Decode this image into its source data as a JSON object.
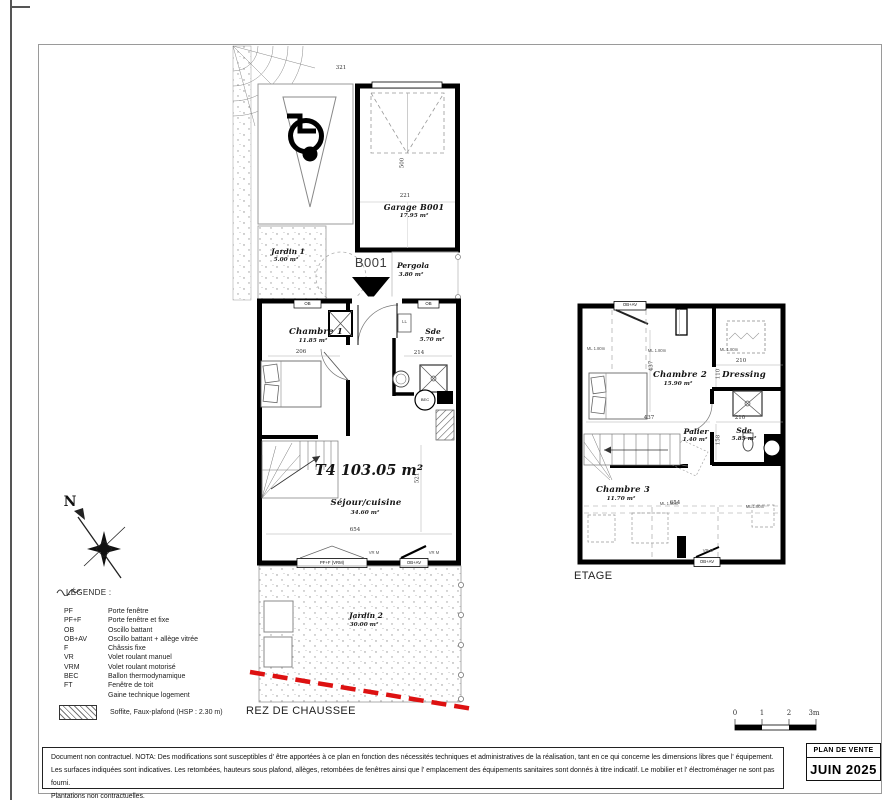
{
  "page": {
    "floor_labels": {
      "ground": "REZ DE CHAUSSEE",
      "upper": "ETAGE"
    },
    "title_box": {
      "title": "PLAN DE VENTE",
      "date": "JUIN 2025"
    },
    "compass_n": "N",
    "scale_ticks": {
      "t0": "0",
      "t1": "1",
      "t2": "2",
      "t3": "3m"
    }
  },
  "ground": {
    "unit_marker": "B001",
    "type_area": "T4 103.05 m²",
    "garage": {
      "name": "Garage B001",
      "area": "17.95 m²",
      "dim_w": "221",
      "dim_h": "500",
      "dim_side": "321"
    },
    "jardin1": {
      "name": "Jardin 1",
      "area": "5.00 m²"
    },
    "pergola": {
      "name": "Pergola",
      "area": "3.80 m²"
    },
    "chambre1": {
      "name": "Chambre 1",
      "area": "11.85 m²",
      "dim": "206"
    },
    "sde": {
      "name": "Sde",
      "area": "5.70 m²",
      "dim": "214"
    },
    "sejour": {
      "name": "Séjour/cuisine",
      "area": "34.60 m²",
      "dim_w": "654",
      "dim_h": "521"
    },
    "jardin2": {
      "name": "Jardin 2",
      "area": "30.00 m²"
    },
    "fixtures": {
      "ll": "LL",
      "bec": "BEC"
    },
    "windows": {
      "ob": "OB",
      "pff": "PF+F (VRM)",
      "obav": "OB+AV",
      "vrm": "VR M"
    }
  },
  "upper": {
    "chambre2": {
      "name": "Chambre 2",
      "area": "15.90 m²",
      "dim_v": "437",
      "dim_h": "437"
    },
    "dressing": {
      "name": "Dressing",
      "dim_w": "210",
      "dim_v": "110"
    },
    "palier": {
      "name": "Palier",
      "area": "1.40 m²"
    },
    "sde": {
      "name": "Sde",
      "area": "5.85 m²",
      "dim_w": "210",
      "dim_v": "158"
    },
    "chambre3": {
      "name": "Chambre 3",
      "area": "11.70 m²",
      "dim_w": "654"
    },
    "height_note": "ML 1.80m",
    "windows": {
      "obav": "OB+AV",
      "vrm": "VR M"
    }
  },
  "legend": {
    "title": "LÉGENDE :",
    "items": [
      {
        "abbr": "PF",
        "label": "Porte fenêtre"
      },
      {
        "abbr": "PF+F",
        "label": "Porte fenêtre et fixe"
      },
      {
        "abbr": "OB",
        "label": "Oscillo battant"
      },
      {
        "abbr": "OB+AV",
        "label": "Oscillo battant + allège vitrée"
      },
      {
        "abbr": "F",
        "label": "Châssis fixe"
      },
      {
        "abbr": "VR",
        "label": "Volet roulant manuel"
      },
      {
        "abbr": "VRM",
        "label": "Volet roulant motorisé"
      },
      {
        "abbr": "BEC",
        "label": "Ballon thermodynamique"
      },
      {
        "abbr": "FT",
        "label": "Fenêtre de toit"
      }
    ],
    "gaine_label": "Gaine technique logement",
    "soffite_label": "Soffite, Faux-plafond (HSP : 2.30 m)"
  },
  "disclaimer": {
    "line1": "Document non contractuel. NOTA: Des modifications sont susceptibles d' être apportées à ce plan en fonction des nécessités techniques et administratives de la réalisation, tant en ce qui concerne les dimensions libres que l' équipement.",
    "line2": "Les surfaces indiquées sont indicatives. Les retombées, hauteurs sous plafond, allèges, retombées de fenêtres ainsi que l' emplacement des équipements sanitaires sont donnés à titre indicatif. Le mobilier et l' électroménager ne sont pas fourni.",
    "line3": "Plantations non contractuelles."
  }
}
